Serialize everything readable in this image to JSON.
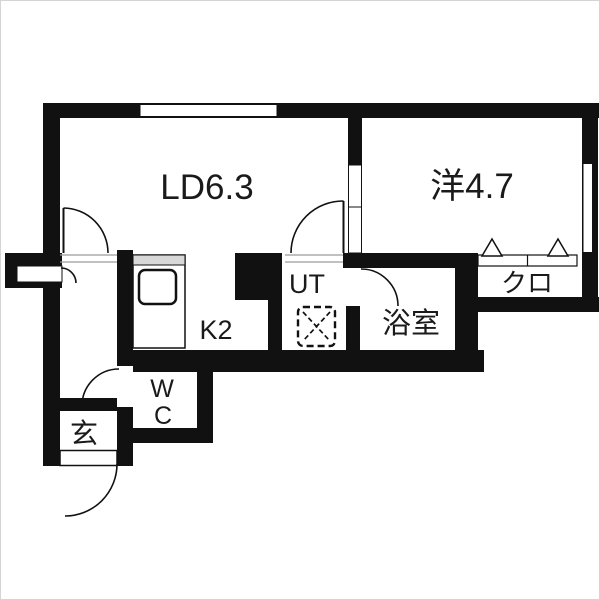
{
  "rooms": {
    "living_dining": "LD6.3",
    "western_room": "洋4.7",
    "closet": "クロ",
    "bathroom": "浴室",
    "utility": "UT",
    "kitchen": "K2",
    "toilet_line1": "W",
    "toilet_line2": "C",
    "entrance": "玄"
  },
  "colors": {
    "walls": "#111111",
    "text": "#1a1a1a",
    "background": "#ffffff",
    "counter_shelf": "#d8d8d8",
    "threshold_line": "#9a9a9a"
  }
}
